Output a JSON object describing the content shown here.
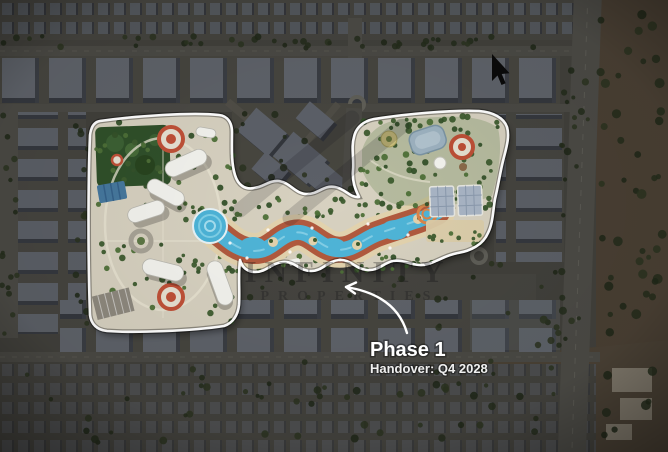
{
  "annotation": {
    "phase_label": "Phase 1",
    "handover_label": "Handover: Q4 2028"
  },
  "watermark": {
    "line1": "INFINITY",
    "line2": "PROPERTIES"
  },
  "icons": {
    "cursor": "mouse-pointer-arrow"
  },
  "colors": {
    "boundary": "#ffffff",
    "ground": "#d7d1c0",
    "river": "#4fb5d8",
    "track": "#b15a3e",
    "deck": "#e3d3ae",
    "park_green": "#30502a",
    "annotation_text": "#ffffff"
  }
}
